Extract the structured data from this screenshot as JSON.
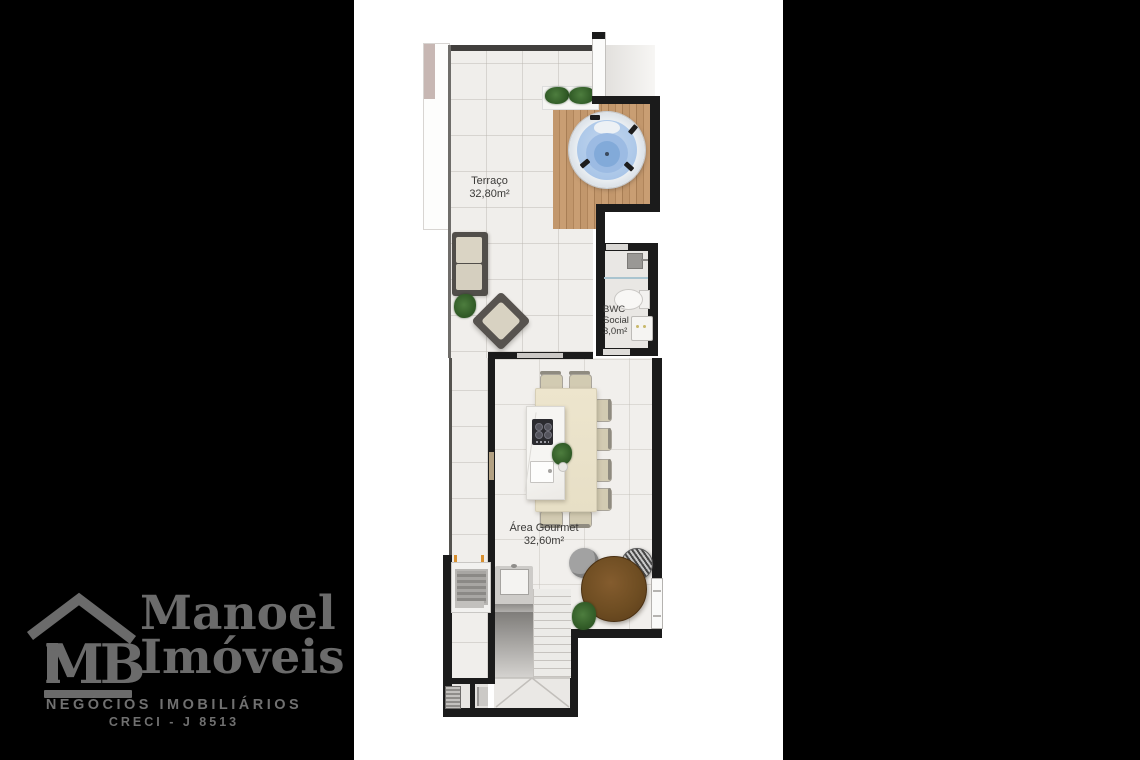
{
  "labels": {
    "terraco": {
      "name": "Terraço",
      "area": "32,80m²"
    },
    "bwc": {
      "l1": "BWC",
      "l2": "Social",
      "l3": "3,0m²"
    },
    "gourmet": {
      "name": "Área Gourmet",
      "area": "32,60m²"
    }
  },
  "rooms": [
    {
      "name": "Terraço",
      "area": "32,80m²"
    },
    {
      "name": "BWC Social",
      "area": "3,0m²"
    },
    {
      "name": "Área Gourmet",
      "area": "32,60m²"
    }
  ],
  "objects": [
    "hot-tub",
    "wood-deck",
    "planter-plants",
    "sofa",
    "armchair",
    "potted-plant",
    "toilet",
    "shower",
    "bathroom-sink",
    "dining-table",
    "kitchen-island",
    "cooktop",
    "island-sink",
    "dining-chairs",
    "round-table",
    "lounge-chairs",
    "barbecue-grill",
    "counter-sink",
    "staircase",
    "glass-door"
  ],
  "logo": {
    "monogram": "MB",
    "name1": "Manoel",
    "name2": "Imóveis",
    "tagline": "NEGÓCIOS IMOBILIÁRIOS",
    "license": "CRECI - J 8513",
    "color": "#6b6b6b"
  },
  "colors": {
    "page_background": "#000000",
    "plan_background": "#ffffff",
    "walls": "#1b1b1b",
    "terrace_floor": "#f0eeeb",
    "deck_wood": "#b98d62",
    "hot_tub_water": "#a9c6e7",
    "dining_table": "#ebe3ca",
    "round_table": "#6f4e23",
    "accent_orange": "#d89030"
  }
}
